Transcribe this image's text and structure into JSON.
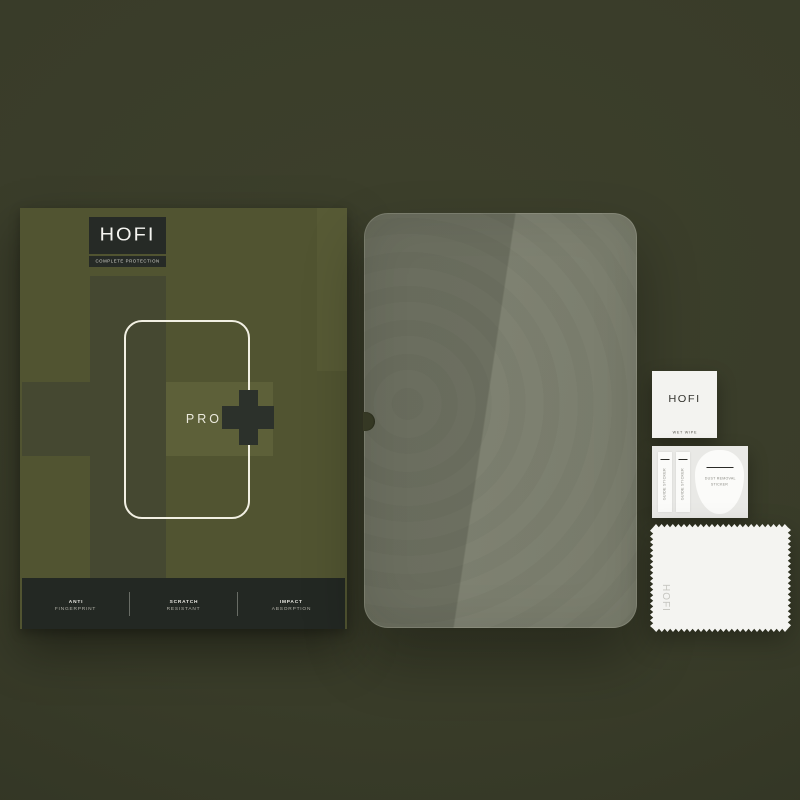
{
  "scene": {
    "description": "HOFI Pro+ tempered glass screen protector set product shot",
    "colors": {
      "background": "#393c29",
      "box_olive": "#515431",
      "box_olive_dark": "#454831",
      "box_olive_light": "#5d6039",
      "box_panel_dark": "#252a25",
      "glass_tint_left": "#6a6d5e",
      "glass_tint_right": "#7e8171",
      "accessory_white": "#f3f3f0",
      "text_light": "#f2f2ee"
    }
  },
  "box": {
    "brand": "HOFI",
    "tagline": "COMPLETE PROTECTION",
    "model": "PRO",
    "features": [
      {
        "line1": "ANTI",
        "line2": "FINGERPRINT"
      },
      {
        "line1": "SCRATCH",
        "line2": "RESISTANT"
      },
      {
        "line1": "IMPACT",
        "line2": "ABSORPTION"
      }
    ]
  },
  "accessories": {
    "wet_wipe": {
      "brand": "HOFI",
      "label": "WET WIPE"
    },
    "sticker_sheet": {
      "guide_label": "GUIDE STICKER",
      "dust_line1": "DUST REMOVAL",
      "dust_line2": "STICKER"
    },
    "cloth": {
      "brand": "HOFI"
    }
  }
}
